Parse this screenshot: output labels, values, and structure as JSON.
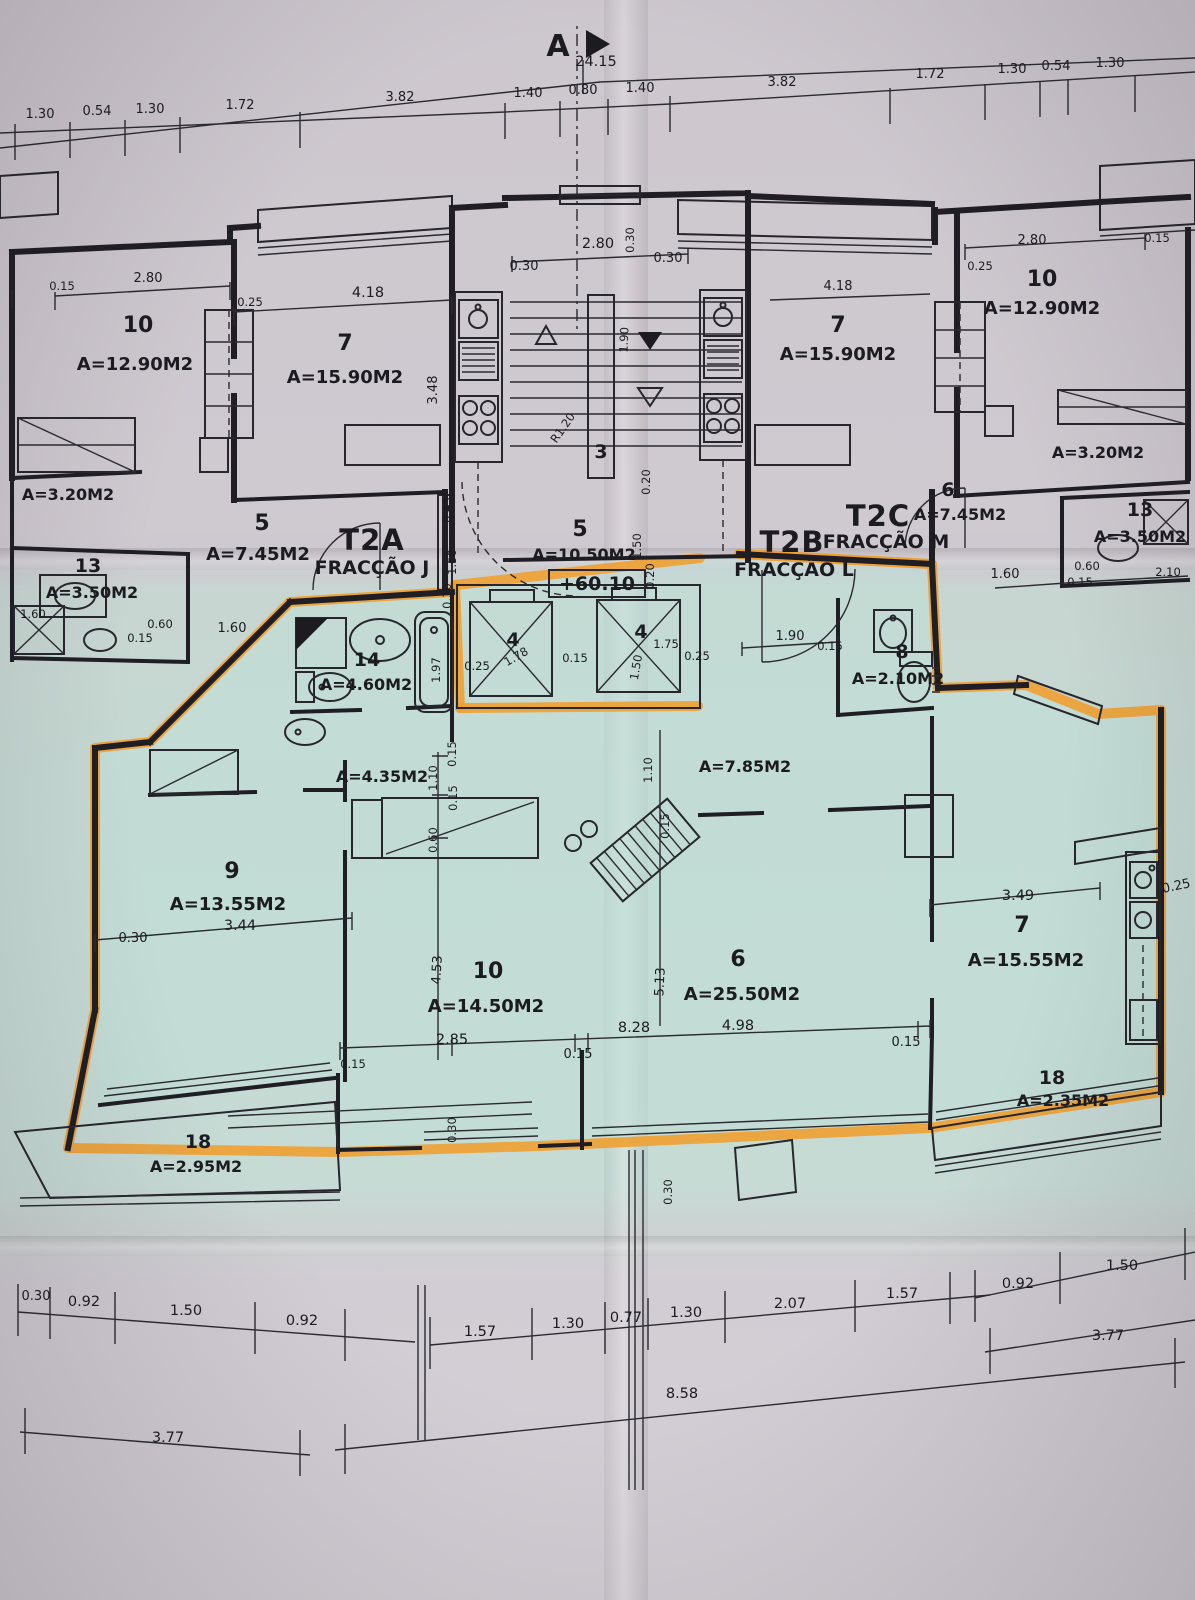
{
  "colors": {
    "paper": "#cbc6ce",
    "unit_band": "#c5d9d3",
    "highlight": "#efa031",
    "ink": "#1b1b20"
  },
  "section": {
    "marker": "A"
  },
  "level": "+60.10",
  "chains": {
    "top_overall": "24.15",
    "top": [
      "1.30",
      "0.54",
      "1.30",
      "1.72",
      "3.82",
      "1.40",
      "0.80",
      "1.40",
      "3.82",
      "1.72",
      "1.30",
      "0.54",
      "1.30"
    ],
    "bottom_row1": [
      "0.30",
      "0.92",
      "1.50",
      "0.92",
      "1.57",
      "1.30",
      "0.77",
      "1.30",
      "2.07",
      "1.57",
      "0.92",
      "1.50"
    ],
    "bottom_row2": [
      "3.77",
      "8.58",
      "3.77"
    ]
  },
  "fractions": {
    "t2a": {
      "code": "T2A",
      "name": "FRACÇÃO J"
    },
    "t2b": {
      "code": "T2B",
      "name": "FRACÇÃO L"
    },
    "t2c": {
      "code": "T2C",
      "name": "FRACÇÃO M"
    }
  },
  "rooms": {
    "left10": {
      "num": "10",
      "area": "A=12.90M2"
    },
    "left7": {
      "num": "7",
      "area": "A=15.90M2"
    },
    "left_closet": {
      "area": "A=3.20M2"
    },
    "left5": {
      "num": "5",
      "area": "A=7.45M2"
    },
    "left13": {
      "num": "13",
      "area": "A=3.50M2"
    },
    "right10": {
      "num": "10",
      "area": "A=12.90M2"
    },
    "right7": {
      "num": "7",
      "area": "A=15.90M2"
    },
    "right_closet": {
      "area": "A=3.20M2"
    },
    "right6": {
      "num": "6",
      "area": "A=7.45M2"
    },
    "right13": {
      "num": "13",
      "area": "A=3.50M2"
    },
    "stair": {
      "num": "3"
    },
    "hall5": {
      "num": "5",
      "area": "A=10.50M2"
    },
    "lift_l": {
      "num": "4"
    },
    "lift_r": {
      "num": "4"
    },
    "bath14": {
      "num": "14",
      "area": "A=4.60M2"
    },
    "wc8": {
      "num": "8",
      "area": "A=2.10M2"
    },
    "hall_a": {
      "area": "A=4.35M2"
    },
    "hall_b": {
      "area": "A=7.85M2"
    },
    "bed9": {
      "num": "9",
      "area": "A=13.55M2"
    },
    "bed10": {
      "num": "10",
      "area": "A=14.50M2"
    },
    "living6": {
      "num": "6",
      "area": "A=25.50M2"
    },
    "kitchen7": {
      "num": "7",
      "area": "A=15.55M2"
    },
    "balc_l": {
      "num": "18",
      "area": "A=2.95M2"
    },
    "balc_r": {
      "num": "18",
      "area": "A=2.35M2"
    }
  },
  "dims": {
    "d015": "0.15",
    "d020": "0.20",
    "d025": "0.25",
    "d030": "0.30",
    "d045": "0.45",
    "d060": "0.60",
    "d110": "1.10",
    "d150": "1.50",
    "d160": "1.60",
    "d175": "1.75",
    "d178": "1.78",
    "d190": "1.90",
    "d197": "1.97",
    "d210": "2.10",
    "d280": "2.80",
    "d285": "2.85",
    "d344": "3.44",
    "d348": "3.48",
    "d349": "3.49",
    "d418": "4.18",
    "d453": "4.53",
    "d498": "4.98",
    "d513": "5.13",
    "d828": "8.28",
    "r120": "R1.20"
  }
}
